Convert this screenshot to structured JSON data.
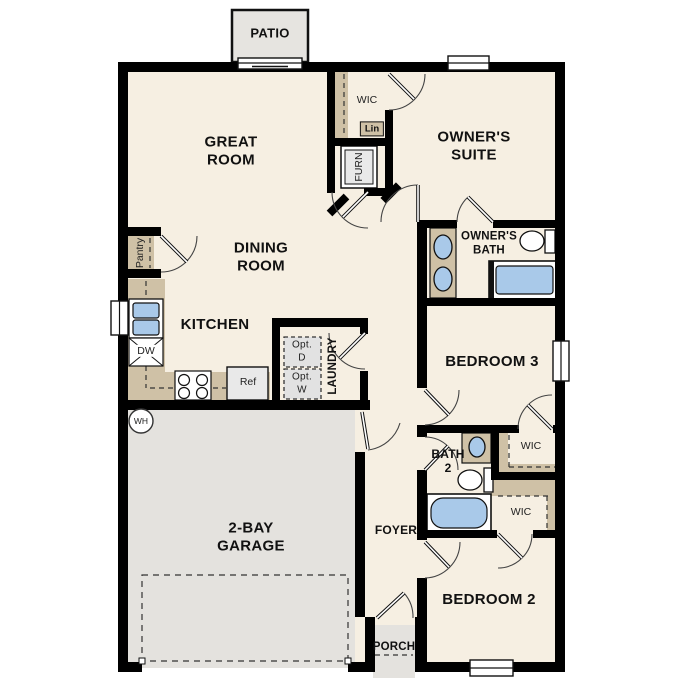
{
  "plan_title": "Single-story floor plan",
  "colors": {
    "wall": "#000000",
    "floor": "#f6efe2",
    "garage_floor": "#e4e2de",
    "patio_floor": "#e6e4e0",
    "casework_tan": "#cfc1a6",
    "fixture_blue": "#a9c9e9",
    "appliance_gray": "#e9e9e9"
  },
  "rooms": {
    "patio": {
      "label": "PATIO"
    },
    "great_room": {
      "label": "GREAT\nROOM"
    },
    "owners_wic": {
      "label": "WIC"
    },
    "linen": {
      "label": "Lin"
    },
    "furnace": {
      "label": "FURN"
    },
    "owners_suite": {
      "label": "OWNER'S\nSUITE"
    },
    "owners_bath": {
      "label": "OWNER'S\nBATH"
    },
    "pantry": {
      "label": "Pantry"
    },
    "dining_room": {
      "label": "DINING\nROOM"
    },
    "kitchen": {
      "label": "KITCHEN"
    },
    "laundry": {
      "label": "LAUNDRY"
    },
    "bedroom3": {
      "label": "BEDROOM 3"
    },
    "bath2": {
      "label": "BATH\n2"
    },
    "wic_bedroom3": {
      "label": "WIC"
    },
    "wic_bedroom2": {
      "label": "WIC"
    },
    "garage": {
      "label": "2-BAY\nGARAGE"
    },
    "foyer": {
      "label": "FOYER"
    },
    "bedroom2": {
      "label": "BEDROOM 2"
    },
    "porch": {
      "label": "PORCH"
    }
  },
  "fixtures": {
    "dishwasher": "DW",
    "refrigerator": "Ref",
    "water_heater": "WH",
    "optional_dryer": "Opt.\nD",
    "optional_washer": "Opt.\nW"
  }
}
